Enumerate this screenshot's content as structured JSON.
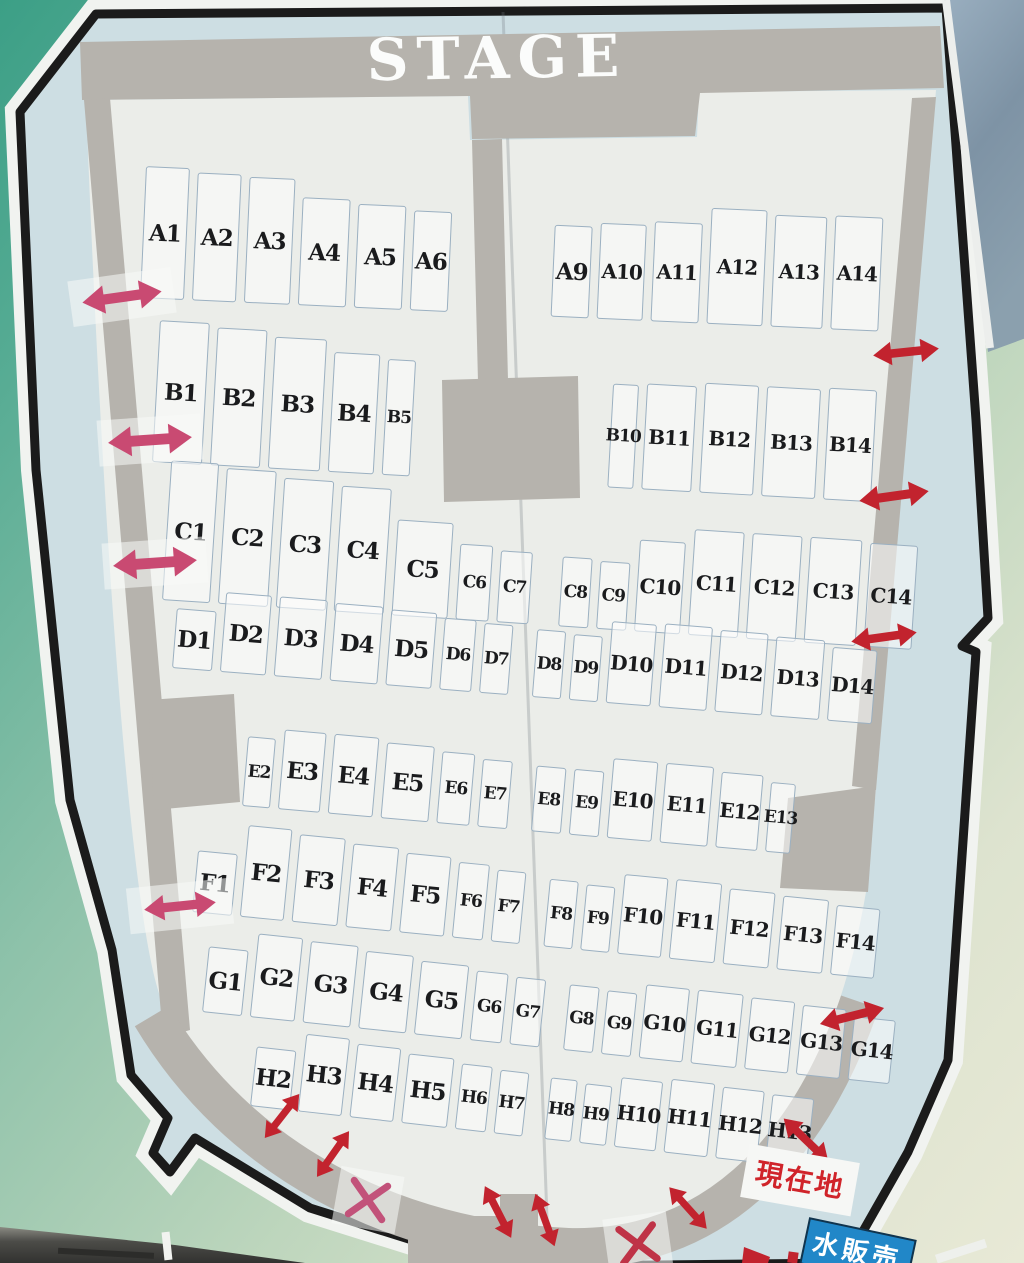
{
  "labels": {
    "stage": "STAGE",
    "current_location": "現在地",
    "water_sign": "水販売"
  },
  "colors": {
    "arrow_red": "#c2232e",
    "arrow_pink": "#c94a72",
    "tape": "rgba(247,249,247,0.55)",
    "board_blue": "#cddee3",
    "seating_white": "#ebede9",
    "stage_gray": "#b6b3ad",
    "outline_black": "#1b1b1b",
    "sign_blue": "#2187c8",
    "location_red": "#d0242a"
  },
  "rows": [
    {
      "name": "A",
      "x": 140,
      "bottom": 298,
      "rot": 2.6,
      "seats": [
        {
          "l": "A1",
          "w": 44,
          "h": 132
        },
        {
          "l": "A2",
          "w": 44,
          "h": 128
        },
        {
          "l": "A3",
          "w": 46,
          "h": 126
        },
        {
          "l": "A4",
          "w": 48,
          "h": 108
        },
        {
          "l": "A5",
          "w": 48,
          "h": 104
        },
        {
          "l": "A6",
          "w": 38,
          "h": 100
        },
        {
          "l": "A9",
          "w": 38,
          "h": 92,
          "ml": 95
        },
        {
          "l": "A10",
          "w": 46,
          "h": 96
        },
        {
          "l": "A11",
          "w": 48,
          "h": 100
        },
        {
          "l": "A12",
          "w": 56,
          "h": 116
        },
        {
          "l": "A13",
          "w": 52,
          "h": 112
        },
        {
          "l": "A14",
          "w": 48,
          "h": 114
        }
      ]
    },
    {
      "name": "B",
      "x": 152,
      "bottom": 462,
      "rot": 3.2,
      "seats": [
        {
          "l": "B1",
          "w": 50,
          "h": 142
        },
        {
          "l": "B2",
          "w": 50,
          "h": 138
        },
        {
          "l": "B3",
          "w": 52,
          "h": 132
        },
        {
          "l": "B4",
          "w": 46,
          "h": 120
        },
        {
          "l": "B5",
          "w": 28,
          "h": 116
        },
        {
          "l": "B10",
          "w": 26,
          "h": 104,
          "ml": 190
        },
        {
          "l": "B11",
          "w": 50,
          "h": 106
        },
        {
          "l": "B12",
          "w": 54,
          "h": 110
        },
        {
          "l": "B13",
          "w": 54,
          "h": 110
        },
        {
          "l": "B14",
          "w": 48,
          "h": 112
        }
      ]
    },
    {
      "name": "C",
      "x": 162,
      "bottom": 600,
      "rot": 3.8,
      "seats": [
        {
          "l": "C1",
          "w": 48,
          "h": 140
        },
        {
          "l": "C2",
          "w": 50,
          "h": 136
        },
        {
          "l": "C3",
          "w": 50,
          "h": 130
        },
        {
          "l": "C4",
          "w": 50,
          "h": 126
        },
        {
          "l": "C5",
          "w": 56,
          "h": 96
        },
        {
          "l": "C6",
          "w": 33,
          "h": 76
        },
        {
          "l": "C7",
          "w": 32,
          "h": 72
        },
        {
          "l": "C8",
          "w": 30,
          "h": 70,
          "ml": 22
        },
        {
          "l": "C9",
          "w": 30,
          "h": 68
        },
        {
          "l": "C10",
          "w": 46,
          "h": 92
        },
        {
          "l": "C11",
          "w": 50,
          "h": 106
        },
        {
          "l": "C12",
          "w": 50,
          "h": 106
        },
        {
          "l": "C13",
          "w": 52,
          "h": 106
        },
        {
          "l": "C14",
          "w": 48,
          "h": 104
        }
      ]
    },
    {
      "name": "D",
      "x": 172,
      "bottom": 668,
      "rot": 4.6,
      "seats": [
        {
          "l": "D1",
          "w": 40,
          "h": 60
        },
        {
          "l": "D2",
          "w": 46,
          "h": 80
        },
        {
          "l": "D3",
          "w": 48,
          "h": 80
        },
        {
          "l": "D4",
          "w": 48,
          "h": 78
        },
        {
          "l": "D5",
          "w": 46,
          "h": 76
        },
        {
          "l": "D6",
          "w": 32,
          "h": 72
        },
        {
          "l": "D7",
          "w": 29,
          "h": 70
        },
        {
          "l": "D8",
          "w": 29,
          "h": 68,
          "ml": 16
        },
        {
          "l": "D9",
          "w": 29,
          "h": 66
        },
        {
          "l": "D10",
          "w": 45,
          "h": 82
        },
        {
          "l": "D11",
          "w": 48,
          "h": 84
        },
        {
          "l": "D12",
          "w": 48,
          "h": 82
        },
        {
          "l": "D13",
          "w": 49,
          "h": 80
        },
        {
          "l": "D14",
          "w": 45,
          "h": 74
        }
      ]
    },
    {
      "name": "E",
      "x": 242,
      "bottom": 806,
      "rot": 5.0,
      "seats": [
        {
          "l": "E2",
          "w": 28,
          "h": 70
        },
        {
          "l": "E3",
          "w": 42,
          "h": 80
        },
        {
          "l": "E4",
          "w": 45,
          "h": 80
        },
        {
          "l": "E5",
          "w": 48,
          "h": 76
        },
        {
          "l": "E6",
          "w": 33,
          "h": 72
        },
        {
          "l": "E7",
          "w": 30,
          "h": 68
        },
        {
          "l": "E8",
          "w": 30,
          "h": 66,
          "ml": 16
        },
        {
          "l": "E9",
          "w": 30,
          "h": 66
        },
        {
          "l": "E10",
          "w": 45,
          "h": 80
        },
        {
          "l": "E11",
          "w": 48,
          "h": 80
        },
        {
          "l": "E12",
          "w": 42,
          "h": 76
        },
        {
          "l": "E13",
          "w": 25,
          "h": 70
        }
      ]
    },
    {
      "name": "F",
      "x": 192,
      "bottom": 912,
      "rot": 5.6,
      "seats": [
        {
          "l": "F1",
          "w": 40,
          "h": 62
        },
        {
          "l": "F2",
          "w": 44,
          "h": 92
        },
        {
          "l": "F3",
          "w": 46,
          "h": 88
        },
        {
          "l": "F4",
          "w": 46,
          "h": 84
        },
        {
          "l": "F5",
          "w": 45,
          "h": 80
        },
        {
          "l": "F6",
          "w": 31,
          "h": 76
        },
        {
          "l": "F7",
          "w": 29,
          "h": 72
        },
        {
          "l": "F8",
          "w": 29,
          "h": 68,
          "ml": 16
        },
        {
          "l": "F9",
          "w": 29,
          "h": 66
        },
        {
          "l": "F10",
          "w": 44,
          "h": 80
        },
        {
          "l": "F11",
          "w": 46,
          "h": 80
        },
        {
          "l": "F12",
          "w": 46,
          "h": 76
        },
        {
          "l": "F13",
          "w": 46,
          "h": 74
        },
        {
          "l": "F14",
          "w": 44,
          "h": 70
        }
      ]
    },
    {
      "name": "G",
      "x": 202,
      "bottom": 1012,
      "rot": 6.0,
      "seats": [
        {
          "l": "G1",
          "w": 40,
          "h": 66
        },
        {
          "l": "G2",
          "w": 45,
          "h": 84
        },
        {
          "l": "G3",
          "w": 48,
          "h": 82
        },
        {
          "l": "G4",
          "w": 48,
          "h": 78
        },
        {
          "l": "G5",
          "w": 48,
          "h": 74
        },
        {
          "l": "G6",
          "w": 32,
          "h": 70
        },
        {
          "l": "G7",
          "w": 30,
          "h": 68
        },
        {
          "l": "G8",
          "w": 30,
          "h": 66,
          "ml": 16
        },
        {
          "l": "G9",
          "w": 30,
          "h": 64
        },
        {
          "l": "G10",
          "w": 44,
          "h": 74
        },
        {
          "l": "G11",
          "w": 46,
          "h": 74
        },
        {
          "l": "G12",
          "w": 44,
          "h": 72
        },
        {
          "l": "G13",
          "w": 44,
          "h": 70
        },
        {
          "l": "G14",
          "w": 42,
          "h": 64
        }
      ]
    },
    {
      "name": "H",
      "x": 250,
      "bottom": 1106,
      "rot": 6.4,
      "seats": [
        {
          "l": "H2",
          "w": 40,
          "h": 60
        },
        {
          "l": "H3",
          "w": 44,
          "h": 78
        },
        {
          "l": "H4",
          "w": 44,
          "h": 74
        },
        {
          "l": "H5",
          "w": 46,
          "h": 70
        },
        {
          "l": "H6",
          "w": 31,
          "h": 66
        },
        {
          "l": "H7",
          "w": 29,
          "h": 64
        },
        {
          "l": "H8",
          "w": 27,
          "h": 62,
          "ml": 14
        },
        {
          "l": "H9",
          "w": 27,
          "h": 60
        },
        {
          "l": "H10",
          "w": 42,
          "h": 70
        },
        {
          "l": "H11",
          "w": 44,
          "h": 74
        },
        {
          "l": "H12",
          "w": 42,
          "h": 72
        },
        {
          "l": "H13",
          "w": 42,
          "h": 70
        }
      ]
    }
  ],
  "markers": {
    "arrows": [
      {
        "kind": "double",
        "color": "pink",
        "x": 122,
        "y": 297,
        "len": 80,
        "rot": -8,
        "tape": true
      },
      {
        "kind": "double",
        "color": "pink",
        "x": 150,
        "y": 440,
        "len": 84,
        "rot": -4,
        "tape": true
      },
      {
        "kind": "double",
        "color": "pink",
        "x": 155,
        "y": 563,
        "len": 84,
        "rot": -4,
        "tape": true
      },
      {
        "kind": "double",
        "color": "pink",
        "x": 180,
        "y": 906,
        "len": 72,
        "rot": -6,
        "tape": true
      },
      {
        "kind": "double",
        "color": "red",
        "x": 906,
        "y": 352,
        "len": 66,
        "rot": -6
      },
      {
        "kind": "double",
        "color": "red",
        "x": 894,
        "y": 496,
        "len": 70,
        "rot": -8
      },
      {
        "kind": "double",
        "color": "red",
        "x": 884,
        "y": 637,
        "len": 66,
        "rot": -8
      },
      {
        "kind": "double",
        "color": "red",
        "x": 852,
        "y": 1016,
        "len": 66,
        "rot": -14
      },
      {
        "kind": "double",
        "color": "red",
        "x": 806,
        "y": 1140,
        "len": 62,
        "rot": 44
      },
      {
        "kind": "double",
        "color": "red",
        "x": 282,
        "y": 1116,
        "len": 56,
        "rot": -52
      },
      {
        "kind": "double",
        "color": "red",
        "x": 333,
        "y": 1154,
        "len": 56,
        "rot": -55
      },
      {
        "kind": "double",
        "color": "red",
        "x": 498,
        "y": 1212,
        "len": 58,
        "rot": 63
      },
      {
        "kind": "double",
        "color": "red",
        "x": 545,
        "y": 1220,
        "len": 56,
        "rot": 70
      },
      {
        "kind": "double",
        "color": "red",
        "x": 688,
        "y": 1208,
        "len": 56,
        "rot": 48
      }
    ],
    "x_marks": [
      {
        "x": 368,
        "y": 1200,
        "rot": 10,
        "color": "#c2527a"
      },
      {
        "x": 638,
        "y": 1244,
        "rot": -8,
        "color": "#bf3347"
      }
    ]
  }
}
